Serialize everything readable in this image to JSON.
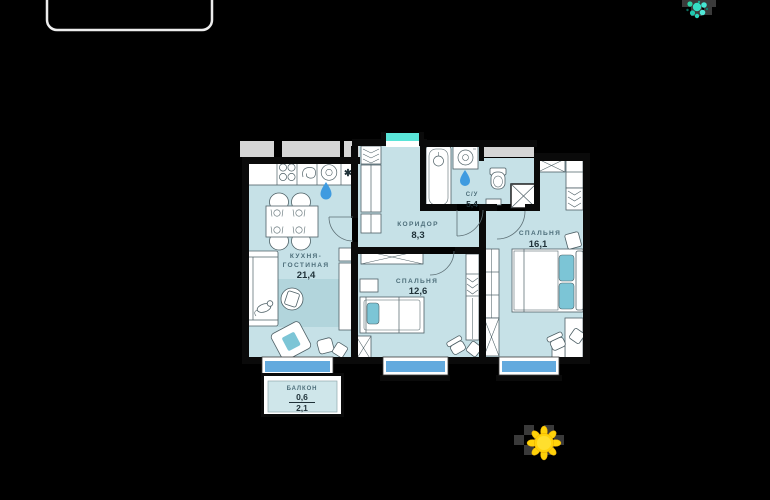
{
  "plan": {
    "rooms": {
      "kitchen_living": {
        "name_line1": "КУХНЯ-",
        "name_line2": "ГОСТИНАЯ",
        "area": "21,4"
      },
      "corridor": {
        "name": "КОРИДОР",
        "area": "8,3"
      },
      "bathroom": {
        "name": "С/У",
        "area": "5,4"
      },
      "bedroom_small": {
        "name": "СПАЛЬНЯ",
        "area": "12,6"
      },
      "bedroom_large": {
        "name": "СПАЛЬНЯ",
        "area": "16,1"
      },
      "balcony": {
        "name": "БАЛКОН",
        "area_coef": "0,6",
        "area_full": "2,1"
      }
    },
    "kitchen_symbols": {
      "asterisk": "✱"
    }
  },
  "icons": {
    "sun": {
      "name": "sun-icon",
      "color": "#ffd20a"
    },
    "sparkle": {
      "name": "teal-sparkle-icon",
      "color": "#35dfc4"
    }
  },
  "colors": {
    "background": "#000000",
    "room_fill": "#c6e1e7",
    "wall": "#0a0a0a",
    "window_glass": "#63aade",
    "entrance_marker": "#59e5d8",
    "accent_teal": "#7cc5d6",
    "rug": "#b2d5dc",
    "water_drop": "#3f9be0",
    "outside_gray": "#d6d6d6",
    "label_text": "#4d6e7a",
    "number_text": "#1f3138"
  }
}
